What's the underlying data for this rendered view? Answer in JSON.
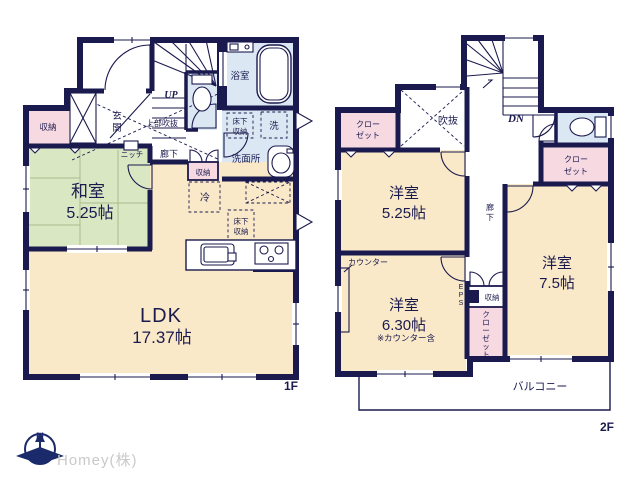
{
  "colors": {
    "wall_navy": "#1b1a4e",
    "room_cream": "#f9e9c8",
    "tatami_green": "#dae7c3",
    "closet_pink": "#f7d9e2",
    "wet_blue": "#dbe8f4",
    "logo_gray": "#c9c9c9"
  },
  "floor1": {
    "floor_label": "1F",
    "washitsu_name": "和室",
    "washitsu_size": "5.25帖",
    "ldk_name": "LDK",
    "ldk_size": "17.37帖",
    "bath": "浴室",
    "washroom": "洗面所",
    "laundry": "洗",
    "fridge": "冷",
    "storage_west": "収納",
    "storage_hall": "収納",
    "genkan_1": "玄",
    "genkan_2": "関",
    "hallway": "廊下",
    "niche": "ニッチ",
    "upper_void": "上部吹抜",
    "up": "UP",
    "underfloor_1a": "床下",
    "underfloor_1b": "収納",
    "underfloor_2a": "床下",
    "underfloor_2b": "収納"
  },
  "floor2": {
    "floor_label": "2F",
    "room525_name": "洋室",
    "room525_size": "5.25帖",
    "room630_name": "洋室",
    "room630_size": "6.30帖",
    "room630_note": "※カウンター含",
    "room75_name": "洋室",
    "room75_size": "7.5帖",
    "void": "吹抜",
    "dn": "DN",
    "counter": "カウンター",
    "storage": "収納",
    "balcony": "バルコニー",
    "hallway_1": "廊",
    "hallway_2": "下",
    "closet_tl_1": "クロー",
    "closet_tl_2": "ゼット",
    "closet_r_1": "クロー",
    "closet_r_2": "ゼット",
    "closet_v_1": "ク",
    "closet_v_2": "ロ",
    "closet_v_3": "ー",
    "closet_v_4": "ゼ",
    "closet_v_5": "ッ",
    "closet_v_6": "ト",
    "eps_1": "E",
    "eps_2": "P",
    "eps_3": "S"
  },
  "footer": {
    "company": "Homey(株)",
    "compass_north": "N"
  }
}
